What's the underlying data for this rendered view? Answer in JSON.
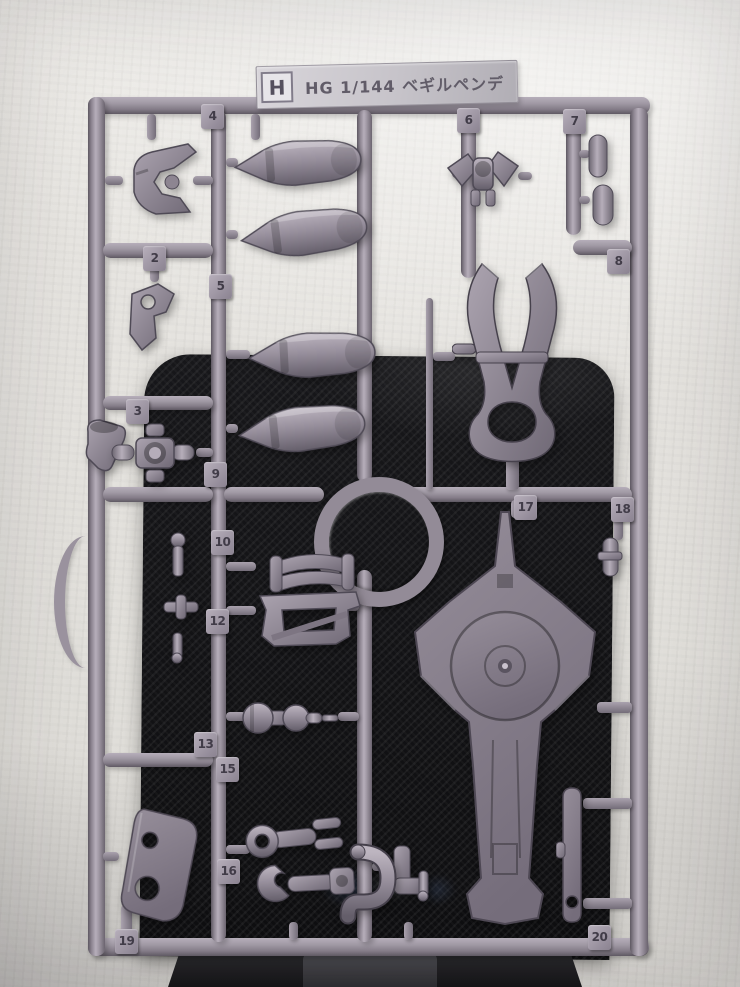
{
  "photo": {
    "label_plate": {
      "letter": "H",
      "title": "HG 1/144 ベギルペンデ"
    },
    "part_tags": [
      {
        "label": "4",
        "x": 201,
        "y": 104
      },
      {
        "label": "6",
        "x": 457,
        "y": 108
      },
      {
        "label": "7",
        "x": 563,
        "y": 109
      },
      {
        "label": "2",
        "x": 143,
        "y": 246
      },
      {
        "label": "5",
        "x": 209,
        "y": 274
      },
      {
        "label": "8",
        "x": 607,
        "y": 249
      },
      {
        "label": "3",
        "x": 126,
        "y": 399
      },
      {
        "label": "9",
        "x": 204,
        "y": 462
      },
      {
        "label": "17",
        "x": 514,
        "y": 495
      },
      {
        "label": "18",
        "x": 611,
        "y": 497
      },
      {
        "label": "10",
        "x": 211,
        "y": 530
      },
      {
        "label": "12",
        "x": 206,
        "y": 609
      },
      {
        "label": "13",
        "x": 194,
        "y": 732
      },
      {
        "label": "15",
        "x": 216,
        "y": 757
      },
      {
        "label": "16",
        "x": 217,
        "y": 859
      },
      {
        "label": "19",
        "x": 115,
        "y": 929
      },
      {
        "label": "20",
        "x": 588,
        "y": 925
      }
    ],
    "colors": {
      "wall": "#e4e2de",
      "panel": "#121214",
      "plastic": "#978f9b",
      "plastic_light": "#b6aeba",
      "plastic_dark": "#5f5964",
      "tag_text": "#413c48"
    }
  }
}
